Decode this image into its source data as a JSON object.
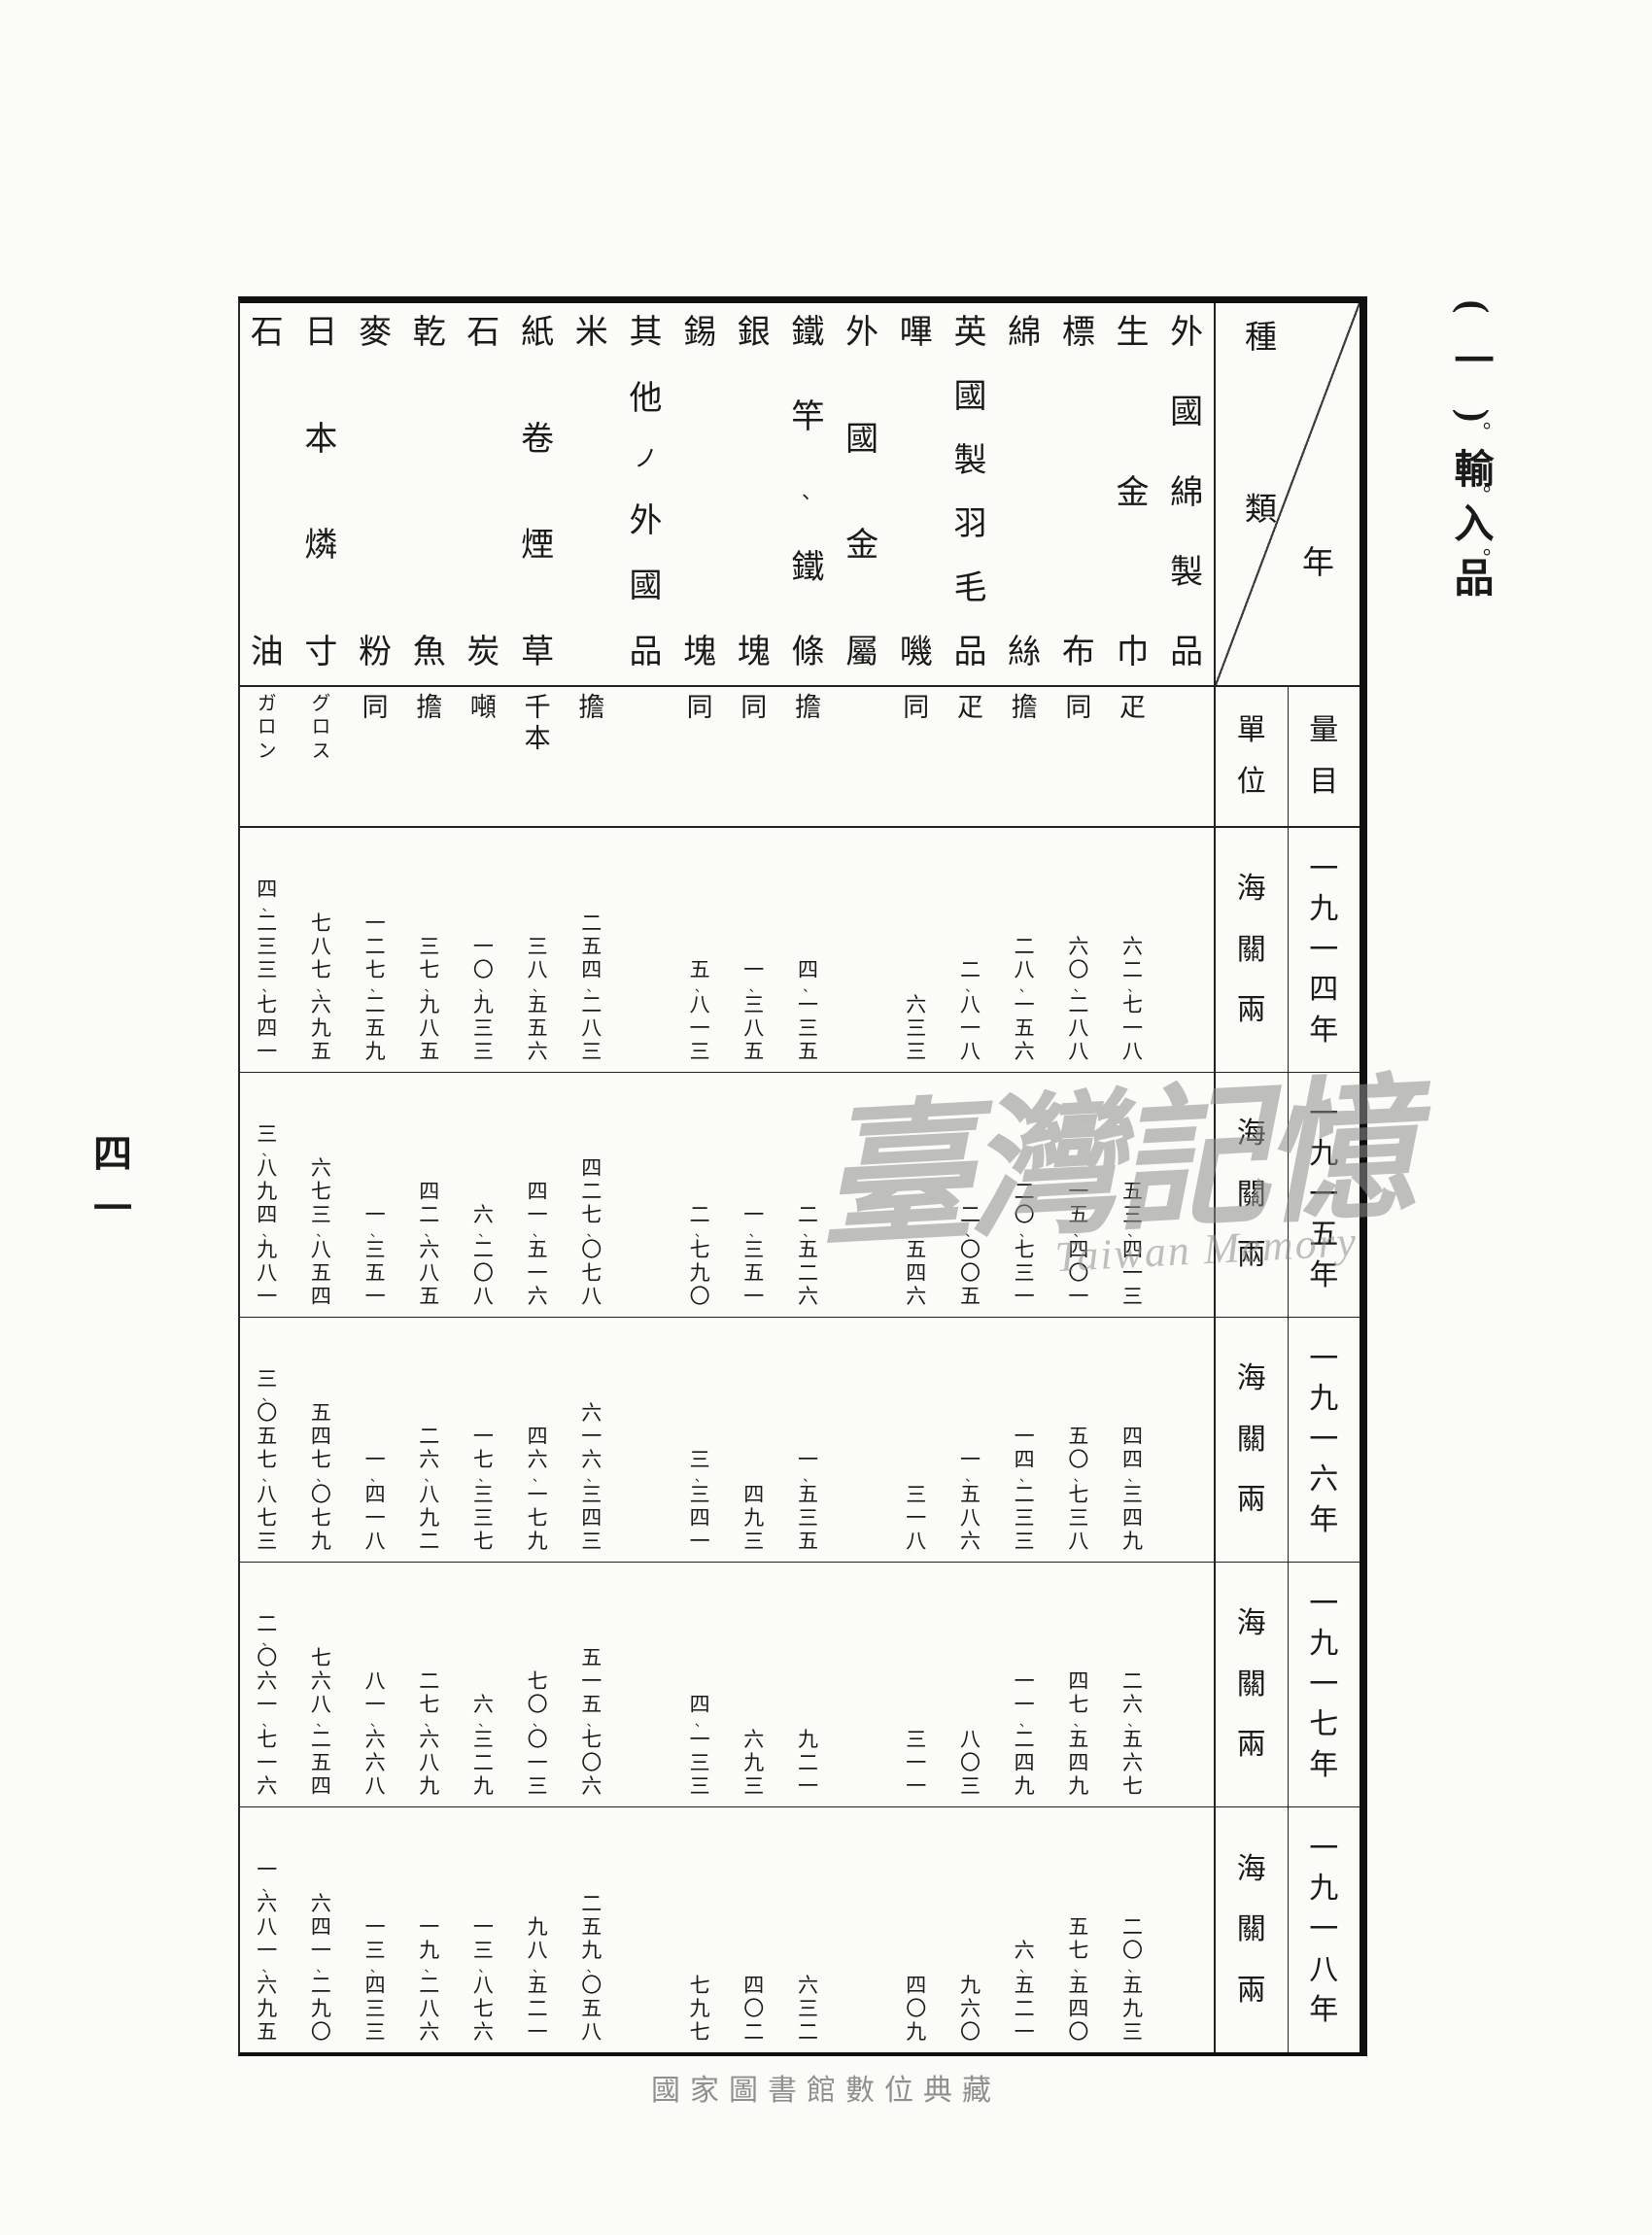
{
  "section": {
    "index": "(一)",
    "title": "輸入品",
    "emphasis_mark": "。"
  },
  "page": {
    "page_number": "四一",
    "watermark_main": "臺灣記憶",
    "watermark_sub": "Taiwan Memory",
    "footer": "國家圖書館數位典藏"
  },
  "table": {
    "corner": {
      "top_right_label": "種類",
      "bottom_left_label": "年"
    },
    "unit_header": "單位",
    "quantity_header": "量目",
    "value_unit": "海關兩",
    "years": [
      "一九一四年",
      "一九一五年",
      "一九一六年",
      "一九一七年",
      "一九一八年"
    ],
    "columns_note": "columns listed in reading order, right to left",
    "columns": [
      {
        "name": "外國綿製品",
        "unit": "",
        "values": [
          "",
          "",
          "",
          "",
          ""
        ]
      },
      {
        "name": "生金巾",
        "unit": "疋",
        "values": [
          "六二、七一八",
          "五三、四一三",
          "四四、三四九",
          "二六、五六七",
          "二〇、五九三"
        ]
      },
      {
        "name": "標布",
        "unit": "同",
        "values": [
          "六〇、二八八",
          "一五、四〇一",
          "五〇、七三八",
          "四七、五四九",
          "五七、五四〇"
        ]
      },
      {
        "name": "綿絲",
        "unit": "擔",
        "values": [
          "二八、一五六",
          "二〇、七三一",
          "一四、二三三",
          "一一、二四九",
          "六、五二一"
        ]
      },
      {
        "name": "英國製羽毛品",
        "unit": "疋",
        "values": [
          "二、八一八",
          "二、〇〇五",
          "一、五八六",
          "八〇三",
          "九六〇"
        ]
      },
      {
        "name": "嗶嘰",
        "unit": "同",
        "values": [
          "六三三",
          "五四六",
          "三一八",
          "三一一",
          "四〇九"
        ]
      },
      {
        "name": "外國金屬",
        "unit": "",
        "values": [
          "",
          "",
          "",
          "",
          ""
        ]
      },
      {
        "name": "鐵竿、鐵條",
        "unit": "擔",
        "values": [
          "四、一三五",
          "二、五二六",
          "一、五三五",
          "九二一",
          "六三二"
        ]
      },
      {
        "name": "銀塊",
        "unit": "同",
        "values": [
          "一、三八五",
          "一、三五一",
          "四九三",
          "六九三",
          "四〇二"
        ]
      },
      {
        "name": "錫塊",
        "unit": "同",
        "values": [
          "五、八一三",
          "二、七九〇",
          "三、三四一",
          "四、一三三",
          "七九七"
        ]
      },
      {
        "name": "其他ノ外國品",
        "unit": "",
        "values": [
          "",
          "",
          "",
          "",
          ""
        ]
      },
      {
        "name": "米",
        "unit": "擔",
        "values": [
          "二五四、二八三",
          "四二七、〇七八",
          "六一六、三四三",
          "五一五、七〇六",
          "二五九、〇五八"
        ]
      },
      {
        "name": "紙卷煙草",
        "unit": "千本",
        "values": [
          "三八、五五六",
          "四一、五一六",
          "四六、一七九",
          "七〇、〇一三",
          "九八、五二一"
        ]
      },
      {
        "name": "石炭",
        "unit": "噸",
        "values": [
          "一〇、九三三",
          "六、二〇八",
          "一七、三三七",
          "六、三二九",
          "一三、八七六"
        ]
      },
      {
        "name": "乾魚",
        "unit": "擔",
        "values": [
          "三七、九八五",
          "四二、六八五",
          "二六、八九二",
          "二七、六八九",
          "一九、二八六"
        ]
      },
      {
        "name": "麥粉",
        "unit": "同",
        "values": [
          "一二七、二五九",
          "一、三五一",
          "一、四一八",
          "八一、六六八",
          "一三、四三三"
        ]
      },
      {
        "name": "日本燐寸",
        "unit": "グロス",
        "values": [
          "七八七、六九五",
          "六七三、八五四",
          "五四七、〇七九",
          "七六八、二五四",
          "六四一、二九〇"
        ]
      },
      {
        "name": "石油",
        "unit": "ガロン",
        "values": [
          "四、二三三、七四一",
          "三、八九四、九八一",
          "三、〇五七、八七三",
          "二、〇六一、七一六",
          "一、六八一、六九五"
        ]
      }
    ]
  }
}
